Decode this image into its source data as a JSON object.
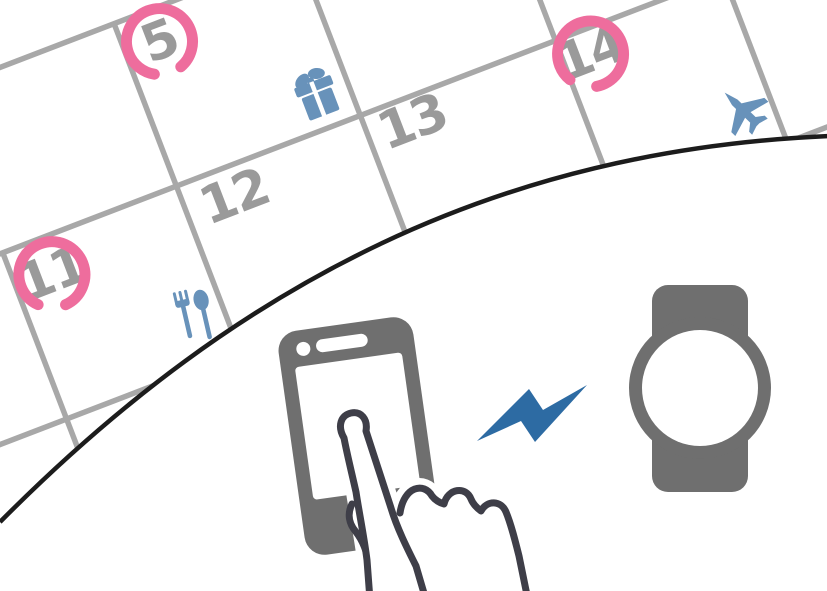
{
  "calendar": {
    "days": [
      {
        "label": "5",
        "circled": true,
        "event_icon": "gift-icon"
      },
      {
        "label": "11",
        "circled": true,
        "event_icon": "meal-icon"
      },
      {
        "label": "12",
        "circled": false,
        "event_icon": ""
      },
      {
        "label": "13",
        "circled": false,
        "event_icon": ""
      },
      {
        "label": "14",
        "circled": true,
        "event_icon": "airplane-icon"
      }
    ],
    "grid_color": "#a8a8a8",
    "number_color": "#9a9a9a",
    "highlight_color": "#ee6d9d",
    "event_icon_color": "#6892ba"
  },
  "scene": {
    "divider_color": "#1c1c1c",
    "device_color": "#6f6f6f",
    "screen_color": "#ffffff",
    "hand_outline_color": "#3e3e48",
    "sync_bolt_color": "#2d6ba3",
    "elements": [
      "calendar-page",
      "smartphone",
      "touch-hand",
      "sync-bolt",
      "smartwatch"
    ]
  }
}
